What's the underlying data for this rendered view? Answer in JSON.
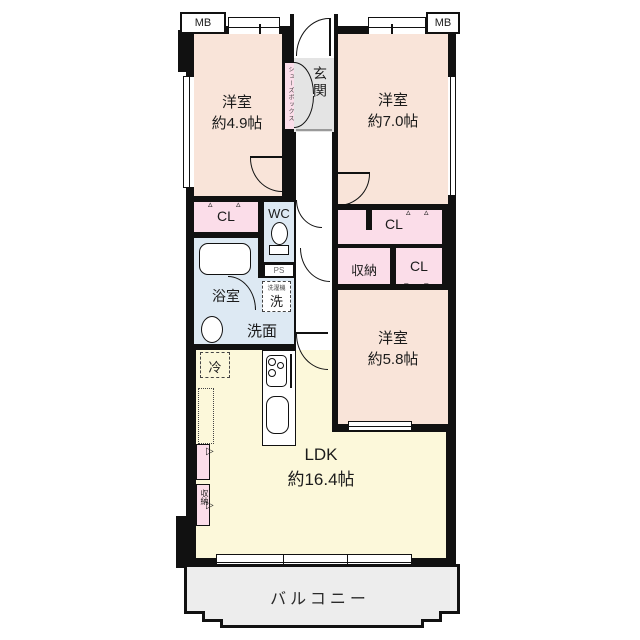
{
  "plan": {
    "rooms": [
      {
        "id": "bedroom-1",
        "name": "洋室",
        "size": "約4.9帖"
      },
      {
        "id": "bedroom-2",
        "name": "洋室",
        "size": "約7.0帖"
      },
      {
        "id": "bedroom-3",
        "name": "洋室",
        "size": "約5.8帖"
      },
      {
        "id": "ldk",
        "name": "LDK",
        "size": "約16.4帖"
      }
    ],
    "labels": {
      "meter_box_left": "MB",
      "meter_box_right": "MB",
      "genkan": "玄関",
      "shoes_box": "シューズボックス",
      "closet_1": "CL",
      "wc": "WC",
      "bath": "浴室",
      "ps": "PS",
      "laundry_mini": "洗濯機",
      "laundry": "洗",
      "washroom": "洗面",
      "storage_mid": "収納",
      "closet_2": "CL",
      "closet_3": "CL",
      "fridge": "冷",
      "storage_ldk": "収納",
      "balcony": "バルコニー"
    },
    "marks": {
      "fold_up": "▵",
      "fold_down": "▿",
      "fold_right": "▷"
    },
    "colors": {
      "wall": "#111111",
      "bedroom": "#f9e4d9",
      "ldk": "#fcf8da",
      "closet": "#fbdde9",
      "wet_area": "#dde9f3",
      "entrance": "#e4e4e4",
      "balcony": "#ededed"
    }
  }
}
